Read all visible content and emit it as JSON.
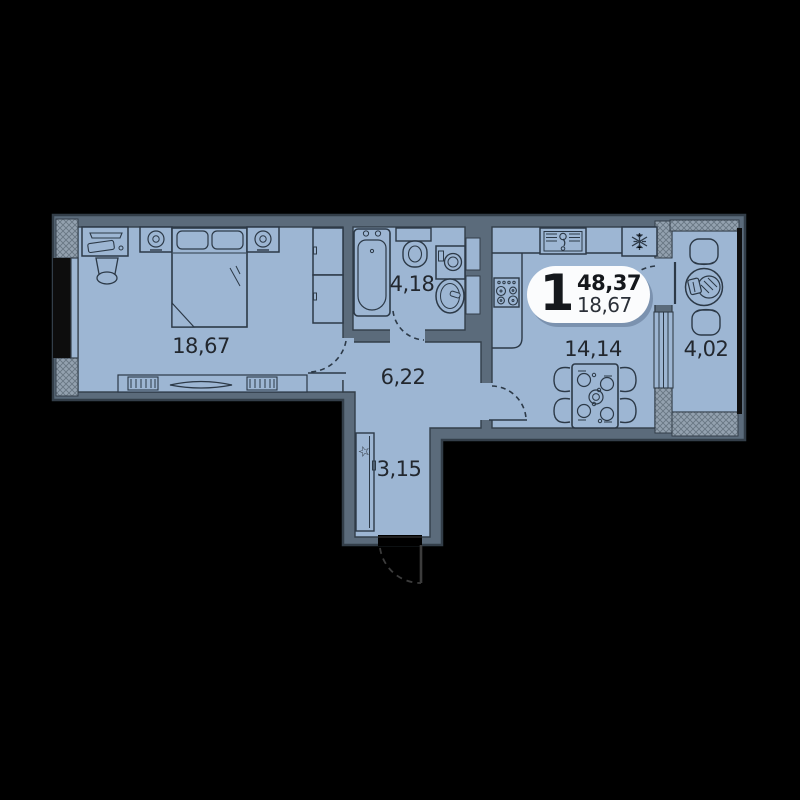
{
  "plan": {
    "title": "1-room apartment floor plan",
    "type_badge": {
      "rooms_count": "1",
      "total_area": "48,37",
      "living_area": "18,67"
    },
    "rooms": [
      {
        "id": "living-room",
        "area": "18,67"
      },
      {
        "id": "bathroom",
        "area": "4,18"
      },
      {
        "id": "hallway",
        "area": "6,22"
      },
      {
        "id": "kitchen",
        "area": "14,14"
      },
      {
        "id": "balcony",
        "area": "4,02"
      },
      {
        "id": "entry-hall",
        "area": "3,15"
      }
    ],
    "icons": {
      "fridge": "snowflake",
      "entry_closet": "star",
      "heating": "radiator-coils",
      "doors": "dashed-swing-arc"
    },
    "colors": {
      "background": "#000000",
      "floor": "#9db6d3",
      "wall": "#5b6b7b",
      "wall_edge": "#333e49",
      "line": "#2c3947",
      "hatch_base": "#93a1af",
      "hatch_line": "#68держ7683",
      "hatch_line_fixed": "#687683",
      "window_glass": "#0d0d0d",
      "badge_bg": "#fbfcfd",
      "text": "#22272e"
    }
  }
}
